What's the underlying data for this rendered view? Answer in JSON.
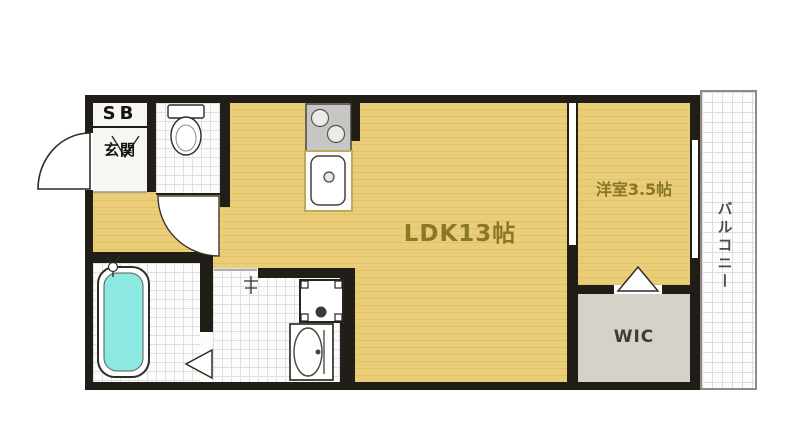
{
  "plan": {
    "name": "apartment-floor-plan",
    "rooms": {
      "ldk": {
        "label": "LDK13帖"
      },
      "western_room": {
        "label": "洋室3.5帖"
      },
      "balcony": {
        "label": "バルコニー"
      },
      "wic": {
        "label": "WIC"
      },
      "entrance": {
        "label": "玄関"
      },
      "shoe_box": {
        "label": "SB"
      }
    },
    "fixtures": [
      "entrance-door",
      "toilet",
      "toilet-door",
      "kitchen-stove",
      "kitchen-sink",
      "bathtub",
      "bathtub-faucet",
      "washbasin",
      "washing-machine-pan",
      "bathroom-folding-door",
      "wic-folding-door",
      "sliding-door",
      "balcony-window",
      "vanity-faucet"
    ],
    "colors": {
      "floor_wood": "#e8cc74",
      "floor_wood_stripe": "#e1c262",
      "wall": "#211e17",
      "room_label": "#8a7728",
      "wic_fill": "#d6d2c9",
      "bathtub_fill": "#8be9e2",
      "tile_line": "#dde0e2",
      "balcony_border": "#8f8b84"
    }
  }
}
